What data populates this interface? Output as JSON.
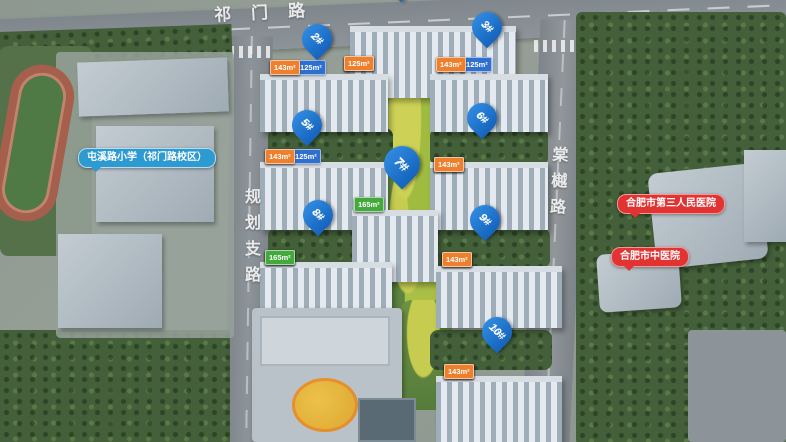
{
  "roads": {
    "top": "祁门路",
    "left": "规划支路",
    "right": "棠樾路"
  },
  "poi": {
    "school": "屯溪路小学（祁门路校区）",
    "hospital1": "合肥市第三人民医院",
    "hospital2": "合肥市中医院"
  },
  "buildings": [
    {
      "id": "1#",
      "floors": "",
      "tags": [
        {
          "text": "125m²",
          "color": "orange"
        },
        {
          "text": "165m²",
          "color": "green"
        },
        {
          "text": "195m²",
          "color": "green"
        },
        {
          "text": "125m²",
          "color": "orange"
        }
      ]
    },
    {
      "id": "2#",
      "floors": "17F",
      "tags": [
        {
          "text": "143m²",
          "color": "orange"
        },
        {
          "text": "125m²+125m²",
          "color": "blue"
        },
        {
          "text": "143m²",
          "color": "orange"
        }
      ]
    },
    {
      "id": "3#",
      "floors": "17F",
      "tags": [
        {
          "text": "143m²",
          "color": "orange"
        },
        {
          "text": "125m²+125m²",
          "color": "blue"
        },
        {
          "text": "143m²",
          "color": "orange"
        }
      ]
    },
    {
      "id": "5#",
      "floors": "17F",
      "tags": [
        {
          "text": "143m²",
          "color": "orange"
        },
        {
          "text": "125m²+125m²",
          "color": "blue"
        },
        {
          "text": "143m²",
          "color": "orange"
        }
      ]
    },
    {
      "id": "6#",
      "floors": "17F",
      "tags": [
        {
          "text": "143m²",
          "color": "orange"
        },
        {
          "text": "125m²",
          "color": "blue"
        },
        {
          "text": "125m²",
          "color": "blue"
        },
        {
          "text": "143m²",
          "color": "orange"
        }
      ]
    },
    {
      "id": "7#",
      "floors": "26F",
      "tags": [
        {
          "text": "165m²",
          "color": "green"
        },
        {
          "text": "165m²",
          "color": "green"
        }
      ]
    },
    {
      "id": "8#",
      "floors": "10F",
      "tags": [
        {
          "text": "165m²",
          "color": "green"
        },
        {
          "text": "165m²",
          "color": "green"
        },
        {
          "text": "165m²",
          "color": "green"
        },
        {
          "text": "165m²",
          "color": "green"
        }
      ]
    },
    {
      "id": "9#",
      "floors": "17F",
      "tags": [
        {
          "text": "143m²",
          "color": "orange"
        },
        {
          "text": "125m²",
          "color": "blue"
        },
        {
          "text": "125m²",
          "color": "blue"
        },
        {
          "text": "143m²",
          "color": "orange"
        }
      ]
    },
    {
      "id": "10#",
      "floors": "10F",
      "tags": [
        {
          "text": "143m²",
          "color": "orange"
        },
        {
          "text": "143m²",
          "color": "orange"
        },
        {
          "text": "143m²",
          "color": "orange"
        },
        {
          "text": "143m²",
          "color": "orange"
        }
      ]
    }
  ],
  "colors": {
    "pin": "#1b74d1",
    "tag_orange": "#ee7f2d",
    "tag_green": "#43a93c",
    "tag_blue": "#2e6fd0",
    "school_pill": "#2e9ad2",
    "hospital_pill": "#e23333"
  }
}
